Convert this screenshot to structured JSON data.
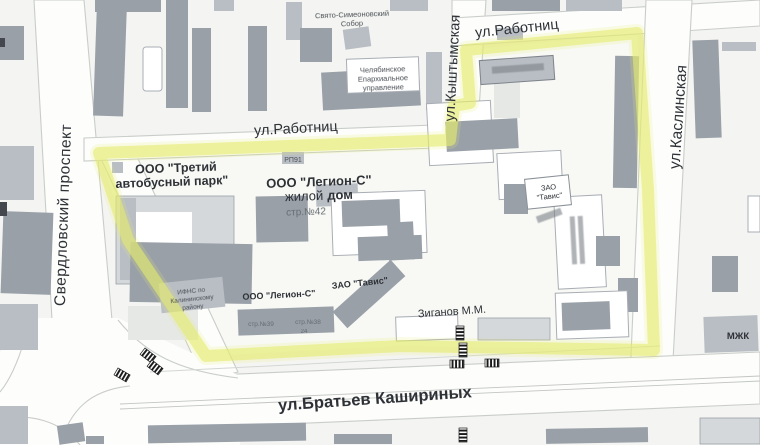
{
  "streets": {
    "sverdlovskiy": "Свердловский проспект",
    "rabotnits": "ул.Работниц",
    "rabotnits_top": "ул.Работниц",
    "kyshtymskaya": "ул.Кыштымская",
    "kaslinskaya": "ул.Каслинская",
    "kashirinykh": "ул.Братьев Кашириных"
  },
  "places": {
    "bus_park_line1": "ООО \"Третий",
    "bus_park_line2": "автобусный парк\"",
    "legion_line1": "ООО \"Легион-С\"",
    "legion_line2_normal": "жилой",
    "legion_line2_bold": "дом",
    "str42": "стр.№42",
    "legion_south": "ООО \"Легион-С\"",
    "tavis_south": "ЗАО \"Тавис\"",
    "tavis_east_line1": "ЗАО",
    "tavis_east_line2": "\"Тавис\"",
    "str39": "стр.№39",
    "str38": "стр.№38",
    "num24": "24",
    "ziganov": "Зиганов М.М.",
    "cathedral_line1": "Свято-Симеоновский",
    "cathedral_line2": "Собор",
    "eparchy_line1": "Челябинское",
    "eparchy_line2": "Епархиальное",
    "eparchy_line3": "управление",
    "ifns_line1": "ИФНС по",
    "ifns_line2": "Калининскому",
    "ifns_line3": "району",
    "mzhk": "МЖК",
    "rp": "РП91"
  },
  "colors": {
    "highlight": "#e4eb6e",
    "building_dark": "#99a0a8",
    "building_mid": "#b9bec4",
    "road": "#fdfdfc",
    "background": "#f4f5f2"
  }
}
